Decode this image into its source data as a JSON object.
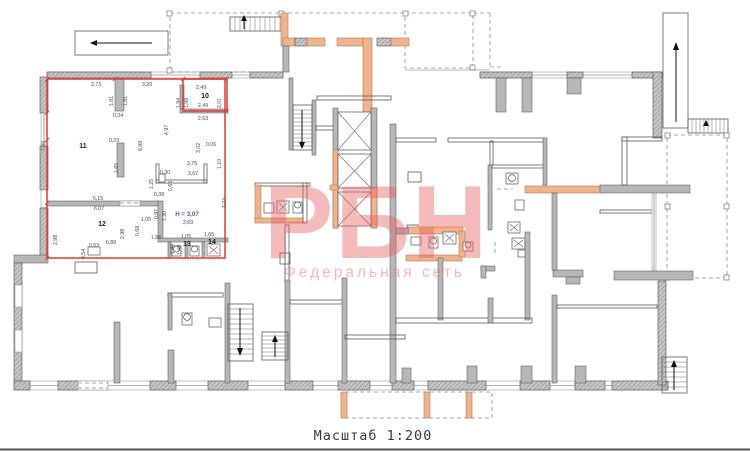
{
  "watermark": {
    "brand": "РБН",
    "subtitle": "Федеральная сеть",
    "color": "#e85c5c"
  },
  "caption": {
    "scale_label": "Масштаб 1:200"
  },
  "plan": {
    "note_height": "H = 3,07",
    "colors": {
      "highlight": "#e23b2e",
      "walls": "#b7b7b7",
      "accent": "#efb48e",
      "note": "#5b51c8"
    },
    "rooms": [
      {
        "number": "10",
        "x": 205,
        "y": 98
      },
      {
        "number": "11",
        "x": 83,
        "y": 148
      },
      {
        "number": "12",
        "x": 102,
        "y": 226
      },
      {
        "number": "13",
        "x": 187,
        "y": 246
      },
      {
        "number": "14",
        "x": 212,
        "y": 244
      }
    ],
    "dims": [
      {
        "t": "3,73",
        "x": 96,
        "y": 86
      },
      {
        "t": "3,20",
        "x": 147,
        "y": 86
      },
      {
        "t": "2,49",
        "x": 201,
        "y": 89
      },
      {
        "t": "1,94",
        "x": 180,
        "y": 103,
        "r": 1
      },
      {
        "t": "1,98",
        "x": 188,
        "y": 103,
        "r": 1
      },
      {
        "t": "2,01",
        "x": 221,
        "y": 103,
        "r": 1
      },
      {
        "t": "2,49",
        "x": 203,
        "y": 107
      },
      {
        "t": "2,63",
        "x": 203,
        "y": 120
      },
      {
        "t": "1,81",
        "x": 113,
        "y": 101,
        "r": 1
      },
      {
        "t": "1,81",
        "x": 127,
        "y": 101,
        "r": 1
      },
      {
        "t": "0,34",
        "x": 118,
        "y": 117
      },
      {
        "t": "4,97",
        "x": 168,
        "y": 130,
        "r": 1
      },
      {
        "t": "6,99",
        "x": 142,
        "y": 146,
        "r": 1
      },
      {
        "t": "0,33",
        "x": 114,
        "y": 142
      },
      {
        "t": "1,65",
        "x": 118,
        "y": 168,
        "r": 1
      },
      {
        "t": "3,02",
        "x": 200,
        "y": 148,
        "r": 1
      },
      {
        "t": "0,06",
        "x": 211,
        "y": 146
      },
      {
        "t": "1,10",
        "x": 221,
        "y": 164,
        "r": 1
      },
      {
        "t": "7,00",
        "x": 45,
        "y": 146,
        "r": 1,
        "c": "#d04030"
      },
      {
        "t": "3,75",
        "x": 192,
        "y": 165
      },
      {
        "t": "3,67",
        "x": 193,
        "y": 175
      },
      {
        "t": "1,25",
        "x": 153,
        "y": 184,
        "r": 1
      },
      {
        "t": "0,30",
        "x": 165,
        "y": 174
      },
      {
        "t": "0,65",
        "x": 172,
        "y": 186,
        "r": 1
      },
      {
        "t": "0,38",
        "x": 159,
        "y": 196
      },
      {
        "t": "3,24",
        "x": 226,
        "y": 203,
        "r": 1
      },
      {
        "t": "6,15",
        "x": 98,
        "y": 200
      },
      {
        "t": "6,07",
        "x": 99,
        "y": 210
      },
      {
        "t": "0,97",
        "x": 158,
        "y": 214,
        "r": 1
      },
      {
        "t": "1,30",
        "x": 166,
        "y": 216,
        "r": 1
      },
      {
        "t": "1,05",
        "x": 146,
        "y": 221
      },
      {
        "t": "0,68",
        "x": 139,
        "y": 231,
        "r": 1
      },
      {
        "t": "3,69",
        "x": 188,
        "y": 224
      },
      {
        "t": "1,86",
        "x": 156,
        "y": 239
      },
      {
        "t": "1,05",
        "x": 186,
        "y": 238
      },
      {
        "t": "1,65",
        "x": 209,
        "y": 236
      },
      {
        "t": "1,44",
        "x": 174,
        "y": 249,
        "r": 1
      },
      {
        "t": "1,40",
        "x": 181,
        "y": 250,
        "r": 1
      },
      {
        "t": "6,88",
        "x": 111,
        "y": 244
      },
      {
        "t": "2,98",
        "x": 57,
        "y": 240,
        "r": 1
      },
      {
        "t": "2,98",
        "x": 124,
        "y": 234,
        "r": 1
      },
      {
        "t": "0,53",
        "x": 94,
        "y": 247
      },
      {
        "t": "0,54",
        "x": 85,
        "y": 254,
        "r": 1
      }
    ]
  }
}
